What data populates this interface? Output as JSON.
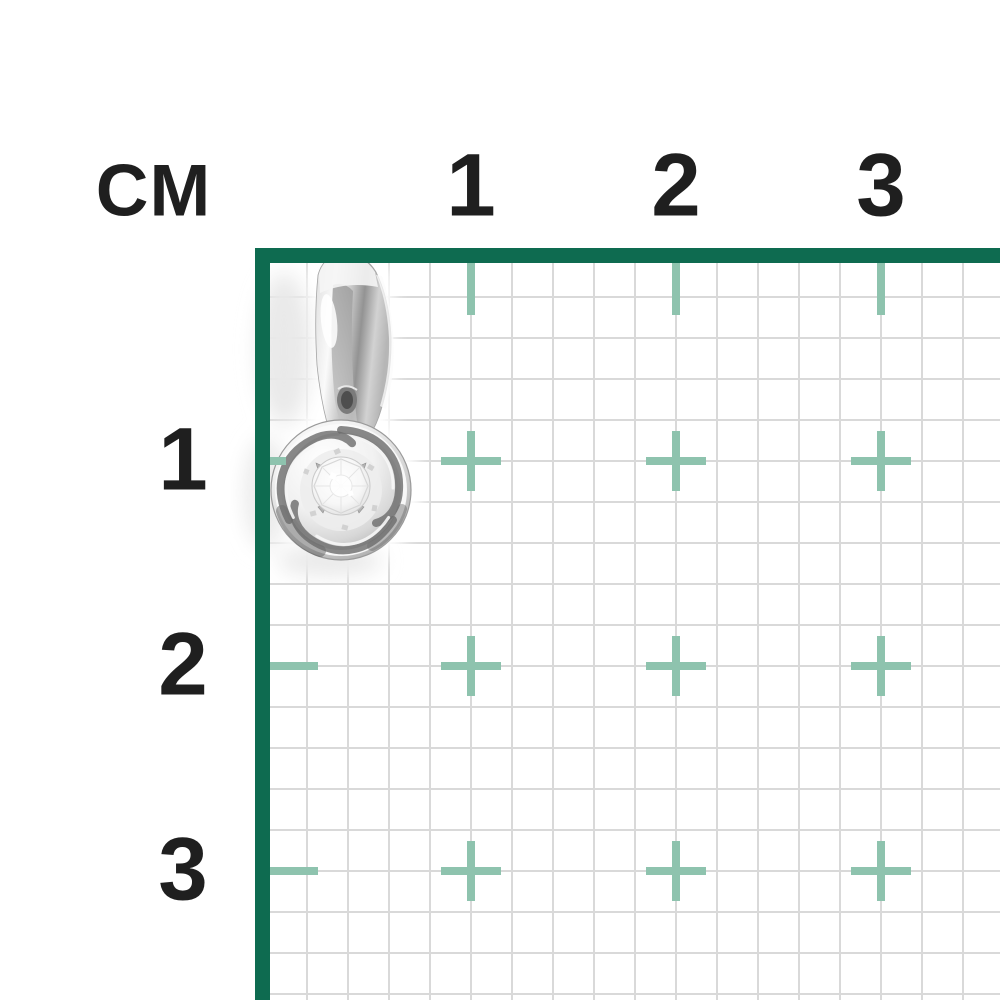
{
  "image_alt": "Silver knot pendant with round diamond shown on a centimeter measurement grid",
  "ruler": {
    "unit_label": "СМ",
    "top_labels": [
      "1",
      "2",
      "3"
    ],
    "left_labels": [
      "1",
      "2",
      "3"
    ]
  },
  "product": {
    "description": "silver swirl (knot) pendant with round diamond center"
  },
  "colors": {
    "ruler_line": "#0e6b50",
    "cm_marker": "#8ec3ae",
    "grid_line": "#d9d9d9",
    "label_text": "#1f1f1f",
    "background": "#ffffff"
  }
}
